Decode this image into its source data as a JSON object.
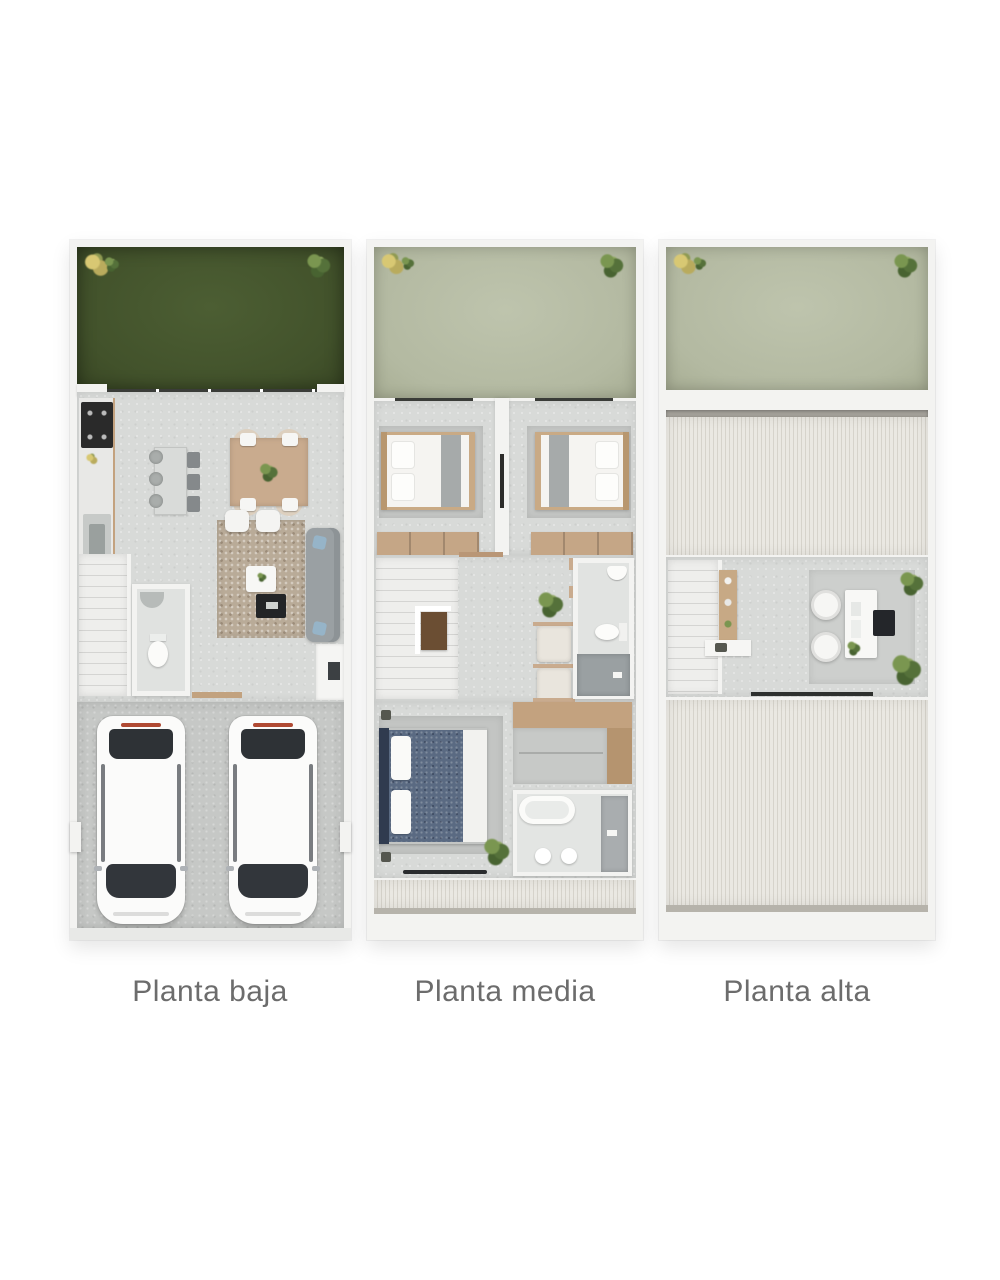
{
  "figure": {
    "type": "architectural-floor-plans",
    "captions": [
      {
        "id": "planta-baja",
        "label": "Planta baja"
      },
      {
        "id": "planta-media",
        "label": "Planta media"
      },
      {
        "id": "planta-alta",
        "label": "Planta alta"
      }
    ]
  },
  "colors": {
    "garden_green": "#46572e",
    "terrace_sage": "#b9bfa8",
    "floor_concrete": "#d8dad8",
    "garage_concrete": "#c6c8c6",
    "wall_white": "#f3f3f1",
    "wood_tan": "#c9ab8e",
    "wood_dark_tan": "#b5946f",
    "stripe_light": "#eae8e2",
    "stripe_dark": "#d6d3cb",
    "rug_taupe": "#b9ab98",
    "sofa_gray": "#9aa0a3",
    "bed_blue": "#5a6a82",
    "headboard_navy": "#303b4f",
    "glass_dark": "#2e3236",
    "accent_red": "#b04a33",
    "plant_green": "#5f7d3e",
    "plant_yellow": "#d3c06a",
    "caption_gray": "#6c6c6c"
  }
}
